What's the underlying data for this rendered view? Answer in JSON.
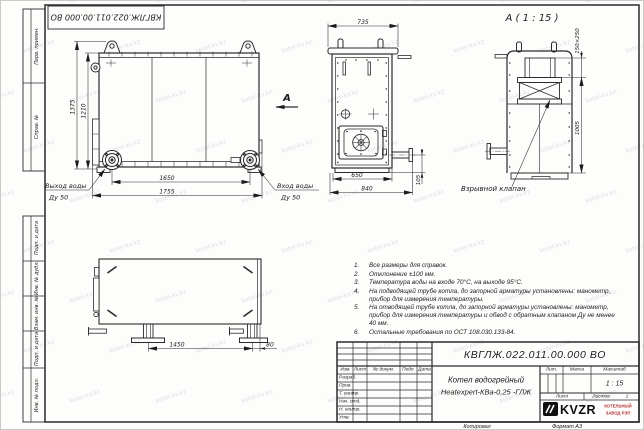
{
  "watermark": {
    "text": "kotel-kv.kz"
  },
  "stamp_top": {
    "text": "КВГЛЖ.022.011.00.000 ВО"
  },
  "margins": {
    "col1": [
      "Перв. примен.",
      "Справ. №"
    ],
    "col2": [
      "Подп. и дата",
      "Инв. № дубл.",
      "Взам. инв. №",
      "Подп. и дата",
      "Инв. № подл."
    ]
  },
  "front_view": {
    "dim_height_total": "1375",
    "dim_height_body": "1210",
    "dim_width_flanges": "1650",
    "dim_width_total": "1755",
    "outlet_line1": "Выход воды",
    "outlet_line2": "Ду 50",
    "inlet_line1": "Вход воды",
    "inlet_line2": "Ду 50",
    "view_arrow": "А"
  },
  "side_view": {
    "dim_top": "735",
    "dim_body": "650",
    "dim_total": "840",
    "dim_pipe": "105"
  },
  "detail_view": {
    "title": "А ( 1 : 15 )",
    "dim_valve": "150×250",
    "dim_height": "1005",
    "label_valve": "Взрывной клапан"
  },
  "plan_view": {
    "dim_legs": "1450",
    "dim_offset": "80"
  },
  "notes": {
    "items": [
      {
        "num": "1.",
        "text": "Все размеры для справок."
      },
      {
        "num": "2.",
        "text": "Отклонение ±100 мм."
      },
      {
        "num": "3.",
        "text": "Температура воды на входе 70°С, на выходе 95°С."
      },
      {
        "num": "4.",
        "text": "На подводящей трубе котла, до запорной арматуры установлены: манометр, прибор для измерения температуры."
      },
      {
        "num": "5.",
        "text": "На отводящей трубе котла, до запорной арматуры установлены: манометр, прибор для измерения температуры и обвод с обратным клапаном Ду не менее 40 мм."
      },
      {
        "num": "6.",
        "text": "Остальные требования по ОСТ 108.030.133-84."
      }
    ]
  },
  "title_block": {
    "doc_number": "КВГЛЖ.022.011.00.000 ВО",
    "rev_headers": {
      "izm": "Изм.",
      "list": "Лист",
      "ndokum": "№ докум.",
      "podp": "Подп.",
      "data": "Дата"
    },
    "rows": [
      "Разраб.",
      "Пров.",
      "Т. контр.",
      "Нач. отд.",
      "Н. контр.",
      "Утв."
    ],
    "name_line1": "Котел водогрейный",
    "name_line2": "Heatexpert-КВа-0,25 -ГЛЖ",
    "lit_label": "Лит.",
    "mass_label": "Масса",
    "scale_label": "Масштаб",
    "scale_value": "1 : 15",
    "sheet_label": "Лист",
    "sheets_label": "Листов",
    "sheets_value": "1",
    "logo_text": "KVZR",
    "logo_sub1": "КОТЕЛЬНЫЙ",
    "logo_sub2": "ЗАВОД РЭП",
    "footer_copied": "Копировал",
    "footer_format": "Формат А3"
  }
}
